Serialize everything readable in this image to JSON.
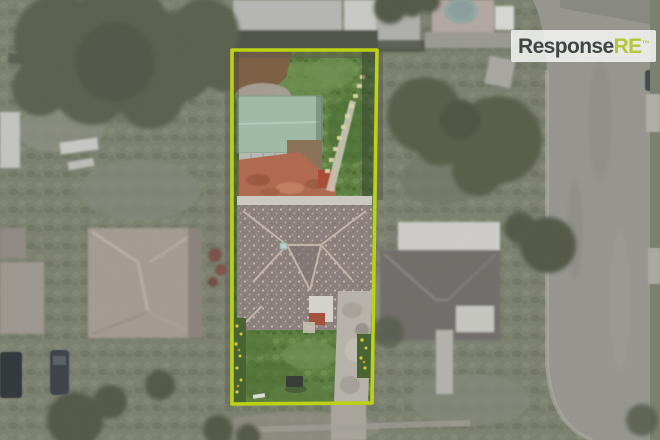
{
  "watermark": {
    "text_primary": "Response",
    "text_accent": "RE",
    "trademark": "™",
    "colors": {
      "primary": "#3f4444",
      "accent": "#b4c738",
      "background": "rgba(246,247,244,0.85)"
    }
  },
  "property_boundary": {
    "color": "#bdd30c",
    "shape": "rectangle-outline"
  },
  "scene_features": [
    "property-boundary-highlight",
    "back-lawn",
    "garden-shed-green-roof",
    "terracotta-patio",
    "stepping-stone-path",
    "main-house-shingle-roof",
    "front-lawn",
    "driveway",
    "flower-beds",
    "neighbor-houses",
    "street",
    "swimming-pool",
    "palm-trees",
    "tree-canopy",
    "parked-cars"
  ]
}
